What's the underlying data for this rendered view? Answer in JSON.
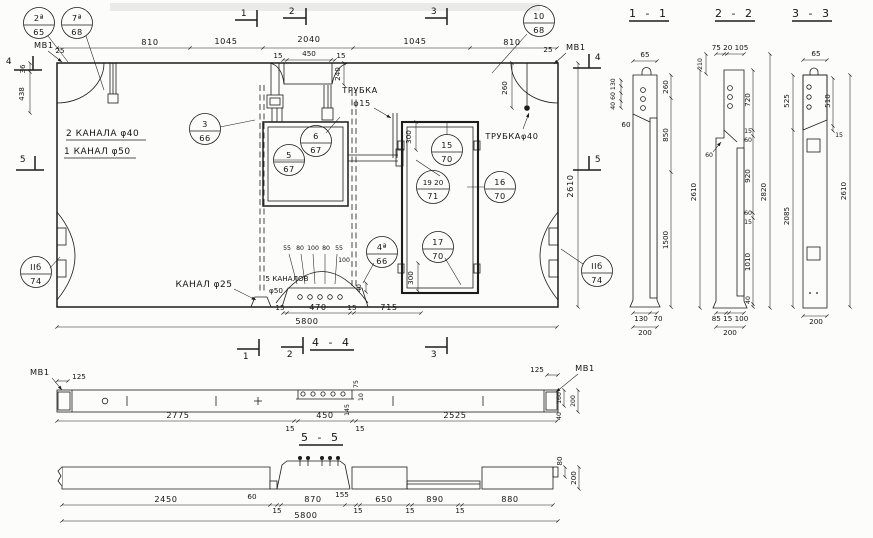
{
  "plan": {
    "callouts": [
      {
        "top": "2ª",
        "bottom": "65"
      },
      {
        "top": "7ª",
        "bottom": "68"
      },
      {
        "top": "10",
        "bottom": "68"
      },
      {
        "top": "3",
        "bottom": "66"
      },
      {
        "top": "5",
        "bottom": "67"
      },
      {
        "top": "6",
        "bottom": "67"
      },
      {
        "top": "15",
        "bottom": "70"
      },
      {
        "top": "19 20",
        "bottom": "71"
      },
      {
        "top": "16",
        "bottom": "70"
      },
      {
        "top": "4ª",
        "bottom": "66"
      },
      {
        "top": "17",
        "bottom": "70"
      },
      {
        "top": "IIб",
        "bottom": "74"
      },
      {
        "top": "IIб",
        "bottom": "74"
      }
    ],
    "markers": {
      "m1": "1",
      "m2": "2",
      "m3": "3",
      "m4": "4",
      "m5": "5"
    },
    "mv1": "МВ1",
    "d25": "25",
    "top_dims": [
      "810",
      "1045",
      "2040",
      "1045",
      "810"
    ],
    "niche_dims": [
      "15",
      "450",
      "15"
    ],
    "v240": "240",
    "v260": "260",
    "v36": "36",
    "v438": "438",
    "v2610": "2610",
    "v300_top": "300",
    "v300_bot": "300",
    "v40": "40",
    "d100": "100",
    "ch_row": [
      "55",
      "80",
      "100",
      "80",
      "55"
    ],
    "bot_dims": [
      "15",
      "470",
      "15",
      "715"
    ],
    "total": "5800",
    "lbl_2kanala": "2 КАНАЛА φ40",
    "lbl_1kanal": "1 КАНАЛ φ50",
    "lbl_trubka": "ТРУБКА",
    "lbl_f15": "φ15",
    "lbl_trubka40": "ТРУБКАφ40",
    "lbl_kanal25": "КАНАЛ φ25",
    "lbl_5kanalov": "5 КАНАЛОВ",
    "lbl_f50": "φ50"
  },
  "s44": {
    "title": "4 - 4",
    "mv1": "МВ1",
    "d125_l": "125",
    "d125_r": "125",
    "d2775": "2775",
    "d15_l": "15",
    "d450": "450",
    "d15_r": "15",
    "d2525": "2525",
    "d75": "75",
    "d10": "10",
    "d145": "145",
    "d160": "160",
    "d200": "200",
    "d40": "40"
  },
  "s55": {
    "title": "5 - 5",
    "dims": [
      "2450",
      "60",
      "15",
      "870",
      "155",
      "15",
      "650",
      "15",
      "890",
      "15",
      "880"
    ],
    "total": "5800",
    "d80": "80",
    "d200": "200"
  },
  "s11": {
    "title": "1 - 1",
    "d65": "65",
    "stack": "40 60 130",
    "d60": "60",
    "d260": "260",
    "d850": "850",
    "d1500": "1500",
    "d130": "130",
    "d70": "70",
    "d200": "200"
  },
  "s22": {
    "title": "2 - 2",
    "top": "75 20 105",
    "d210": "210",
    "d2610": "2610",
    "d60l": "60",
    "d720": "720",
    "d15a": "15",
    "d60a": "60",
    "d920": "920",
    "d60b": "60",
    "d15b": "15",
    "d1010": "1010",
    "d40": "40",
    "d2820": "2820",
    "bot": "85 15 100",
    "d200": "200"
  },
  "s33": {
    "title": "3 - 3",
    "d65": "65",
    "d525": "525",
    "d2085": "2085",
    "d510": "510",
    "d15": "15",
    "d2610": "2610",
    "d200": "200"
  }
}
